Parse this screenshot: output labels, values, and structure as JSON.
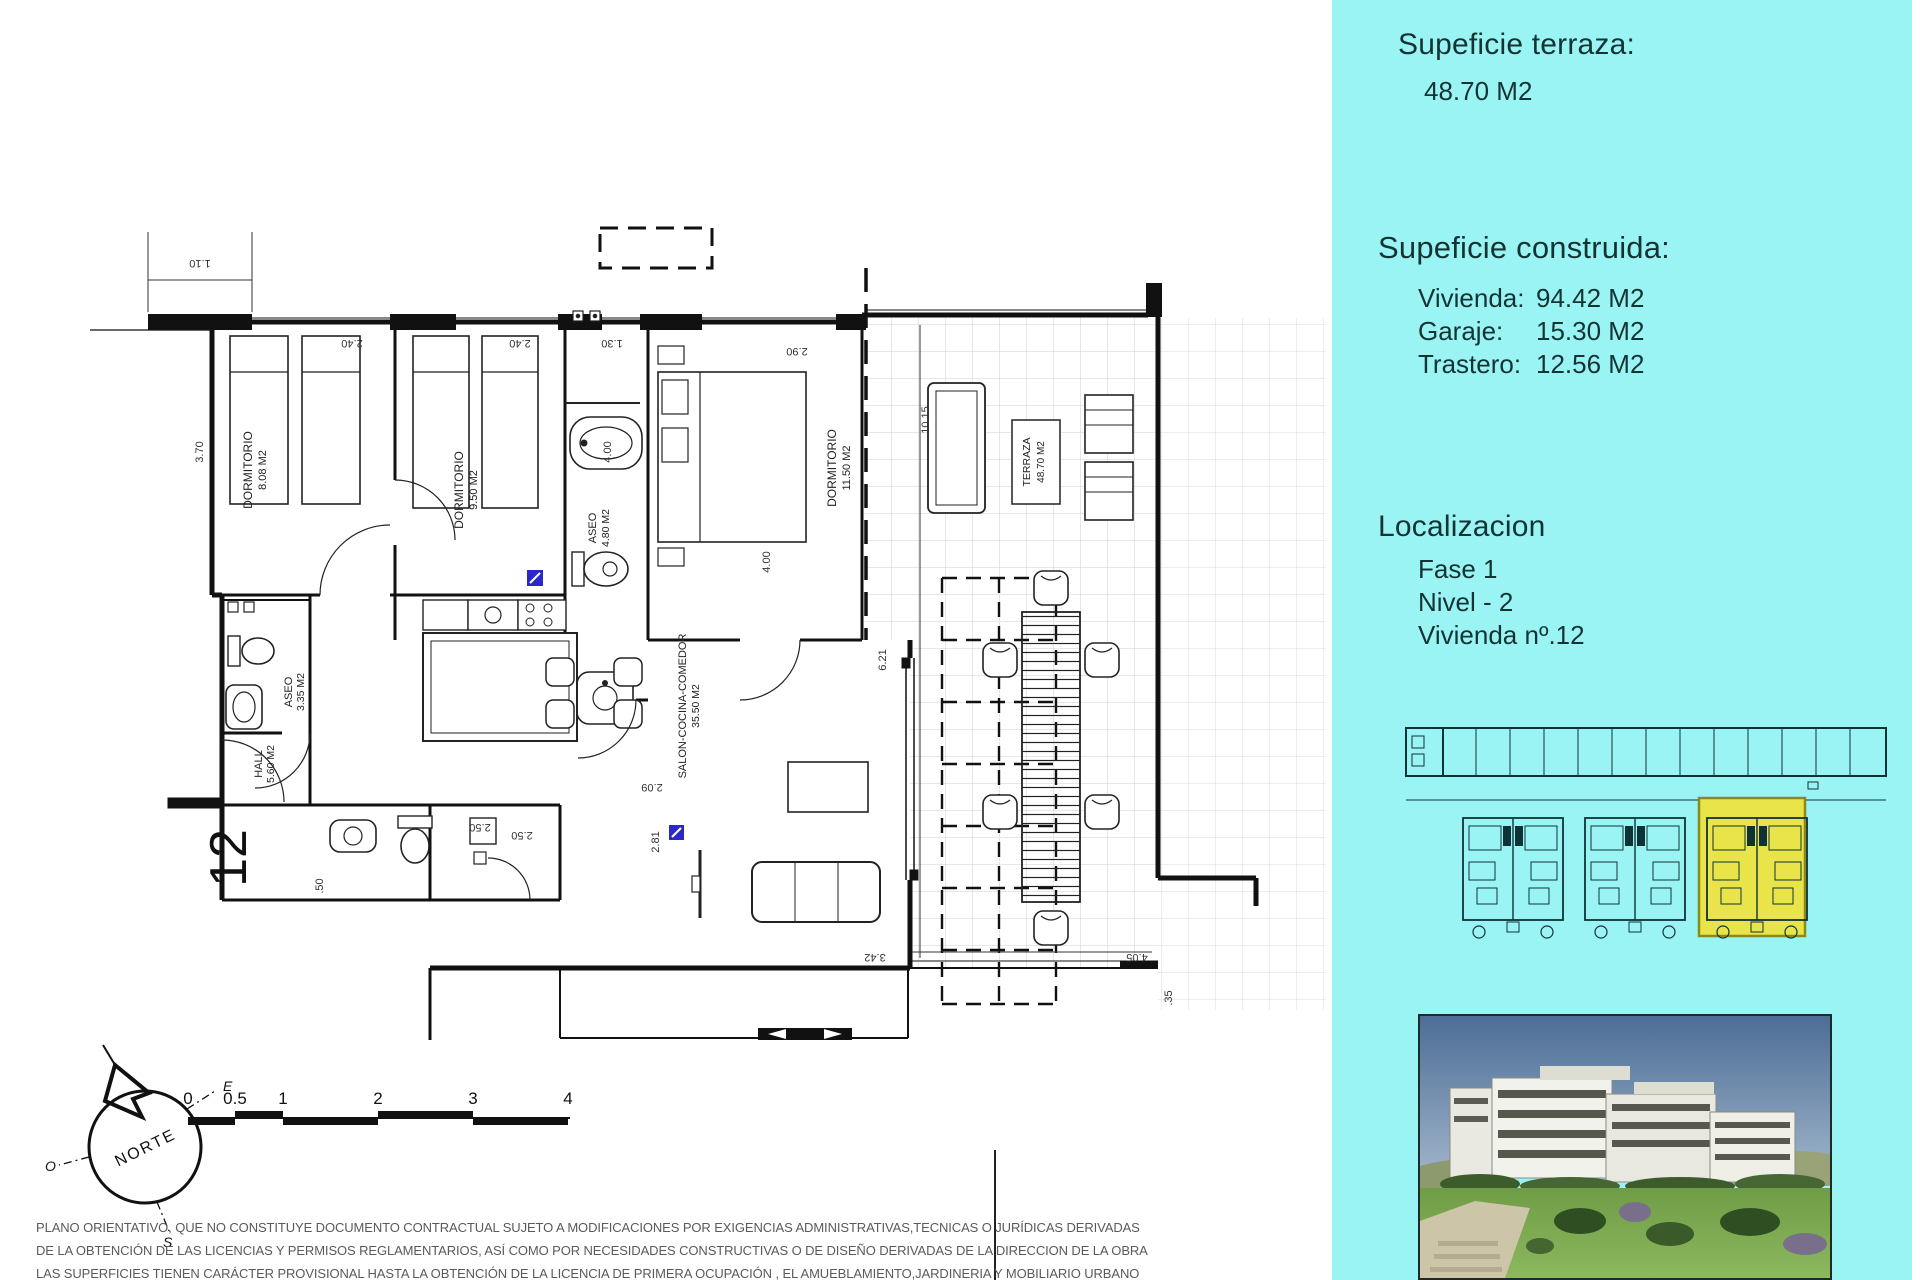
{
  "sidebar": {
    "terraza_heading": "Supeficie terraza:",
    "terraza_value": "48.70 M2",
    "construida_heading": "Supeficie construida:",
    "construida_items": [
      {
        "label": "Vivienda:",
        "value": "94.42 M2"
      },
      {
        "label": "Garaje:",
        "value": "15.30 M2"
      },
      {
        "label": "Trastero:",
        "value": "12.56 M2"
      }
    ],
    "localizacion_heading": "Localizacion",
    "localizacion_items": [
      "Fase 1",
      "Nivel - 2",
      "Vivienda nº.12"
    ]
  },
  "plan": {
    "unit_number": "12",
    "rooms": {
      "dormitorio1": {
        "name": "DORMITORIO",
        "area": "8.08 M2"
      },
      "dormitorio2": {
        "name": "DORMITORIO",
        "area": "9.50 M2"
      },
      "dormitorio3": {
        "name": "DORMITORIO",
        "area": "11.50 M2"
      },
      "aseo1": {
        "name": "ASEO",
        "area": "3.35 M2"
      },
      "aseo2": {
        "name": "ASEO",
        "area": "4.80 M2"
      },
      "hall": {
        "name": "HALL",
        "area": "5.60 M2"
      },
      "salon": {
        "name": "SALON-COCINA-COMEDOR",
        "area": "35.50 M2"
      },
      "terraza": {
        "name": "TERRAZA",
        "area": "48.70 M2"
      }
    },
    "dimensions": {
      "d110": "1.10",
      "d370": "3.70",
      "d240a": "2.40",
      "d240b": "2.40",
      "d130": "1.30",
      "d290": "2.90",
      "d400a": "4.00",
      "d400b": "4.00",
      "d1015": "10.15",
      "d621": "6.21",
      "d281": "2.81",
      "d209": "2.09",
      "d250a": "2.50",
      "d250b": "2.50",
      "d050": ".50",
      "d342": "3.42",
      "d035": ".35",
      "d405": "4.05"
    }
  },
  "compass": {
    "north": "NORTE",
    "east": "E",
    "west": "O",
    "south": "S"
  },
  "scalebar": {
    "ticks": [
      "0",
      "0.5",
      "1",
      "2",
      "3",
      "4"
    ]
  },
  "disclaimer": {
    "line1": "PLANO ORIENTATIVO, QUE NO CONSTITUYE DOCUMENTO CONTRACTUAL SUJETO A MODIFICACIONES POR EXIGENCIAS ADMINISTRATIVAS,TECNICAS O JURÍDICAS DERIVADAS",
    "line2": "DE LA OBTENCIÓN DE LAS LICENCIAS Y PERMISOS REGLAMENTARIOS, ASÍ COMO POR NECESIDADES CONSTRUCTIVAS  O DE DISEÑO DERIVADAS DE LA DIRECCION DE LA OBRA",
    "line3": "LAS SUPERFICIES TIENEN CARÁCTER PROVISIONAL HASTA LA OBTENCIÓN DE LA LICENCIA DE PRIMERA OCUPACIÓN , EL AMUEBLAMIENTO,JARDINERIA Y MOBILIARIO URBANO"
  },
  "colors": {
    "panel_bg": "#9BF4F4",
    "highlight": "#E8E44A",
    "marker_blue": "#2A28C8",
    "plan_line": "#111111"
  }
}
